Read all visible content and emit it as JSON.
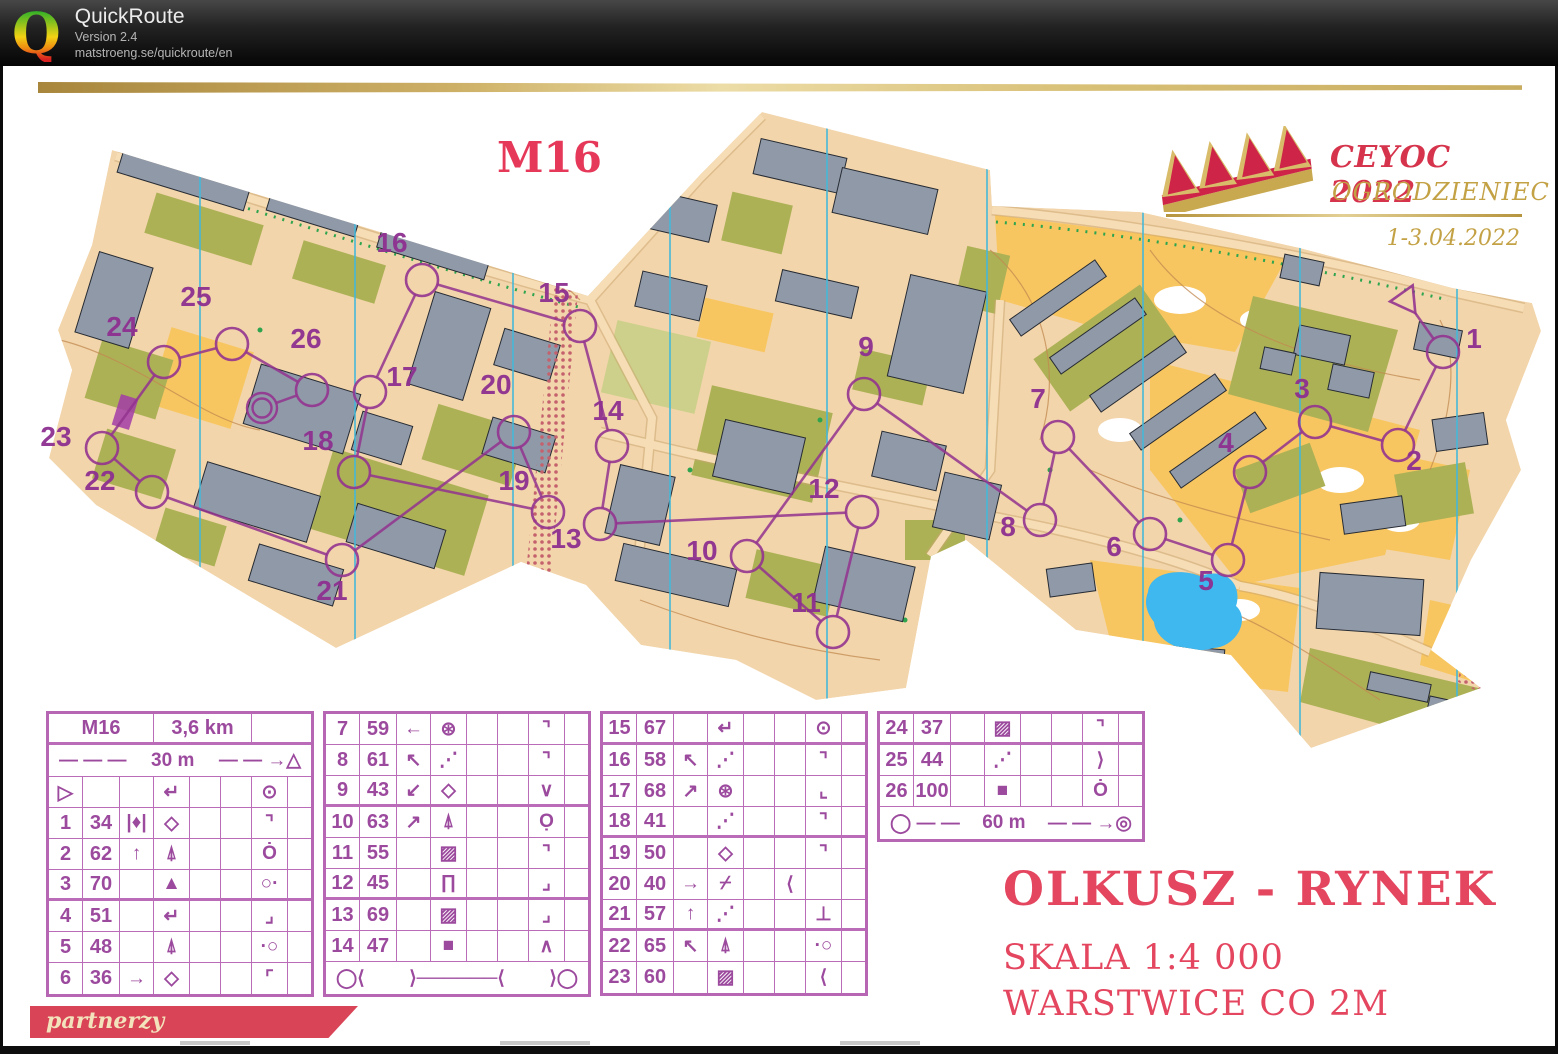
{
  "header": {
    "app_name": "QuickRoute",
    "version": "Version 2.4",
    "url": "matstroeng.se/quickroute/en",
    "logo_letter": "Q"
  },
  "map": {
    "class_label": "M16",
    "event": {
      "title": "CEYOC 2022",
      "location": "OGRODZIENIEC",
      "dates": "1-3.04.2022"
    },
    "titles": {
      "name": "OLKUSZ - RYNEK",
      "scale": "SKALA 1:4 000",
      "contours": "WARSTWICE CO 2M",
      "partners": "partnerzy"
    },
    "colors": {
      "course_purple": "#93348f",
      "crimson": "#e6395a",
      "gold": "#c2a14e",
      "olive_green": "#adb156",
      "building_gray": "#9099a8",
      "paved_tan": "#f2d5ab",
      "open_orange": "#f8c661",
      "water_blue": "#3fb7ef",
      "north_line_cyan": "#45b8d8",
      "oob_red": "#c4616d"
    },
    "north_lines_x": [
      200,
      355,
      513,
      670,
      827,
      987,
      1143,
      1300,
      1457
    ],
    "start": {
      "x": 1406,
      "y": 300
    },
    "finish": {
      "x": 262,
      "y": 408
    },
    "controls": [
      {
        "n": "1",
        "cx": 1443,
        "cy": 352,
        "lx": 1474,
        "ly": 348
      },
      {
        "n": "2",
        "cx": 1398,
        "cy": 445,
        "lx": 1414,
        "ly": 470
      },
      {
        "n": "3",
        "cx": 1315,
        "cy": 422,
        "lx": 1302,
        "ly": 398
      },
      {
        "n": "4",
        "cx": 1250,
        "cy": 472,
        "lx": 1226,
        "ly": 452
      },
      {
        "n": "5",
        "cx": 1228,
        "cy": 560,
        "lx": 1206,
        "ly": 590
      },
      {
        "n": "6",
        "cx": 1150,
        "cy": 534,
        "lx": 1114,
        "ly": 556
      },
      {
        "n": "7",
        "cx": 1058,
        "cy": 437,
        "lx": 1038,
        "ly": 408
      },
      {
        "n": "8",
        "cx": 1040,
        "cy": 520,
        "lx": 1008,
        "ly": 536
      },
      {
        "n": "9",
        "cx": 864,
        "cy": 394,
        "lx": 866,
        "ly": 356
      },
      {
        "n": "10",
        "cx": 747,
        "cy": 556,
        "lx": 702,
        "ly": 560
      },
      {
        "n": "11",
        "cx": 833,
        "cy": 632,
        "lx": 806,
        "ly": 612
      },
      {
        "n": "12",
        "cx": 862,
        "cy": 512,
        "lx": 824,
        "ly": 498
      },
      {
        "n": "13",
        "cx": 600,
        "cy": 524,
        "lx": 566,
        "ly": 548
      },
      {
        "n": "14",
        "cx": 612,
        "cy": 446,
        "lx": 608,
        "ly": 420
      },
      {
        "n": "15",
        "cx": 580,
        "cy": 326,
        "lx": 554,
        "ly": 302
      },
      {
        "n": "16",
        "cx": 422,
        "cy": 280,
        "lx": 392,
        "ly": 252
      },
      {
        "n": "17",
        "cx": 370,
        "cy": 392,
        "lx": 402,
        "ly": 386
      },
      {
        "n": "18",
        "cx": 354,
        "cy": 472,
        "lx": 318,
        "ly": 450
      },
      {
        "n": "19",
        "cx": 548,
        "cy": 512,
        "lx": 514,
        "ly": 490
      },
      {
        "n": "20",
        "cx": 514,
        "cy": 432,
        "lx": 496,
        "ly": 394
      },
      {
        "n": "21",
        "cx": 342,
        "cy": 560,
        "lx": 332,
        "ly": 600
      },
      {
        "n": "22",
        "cx": 152,
        "cy": 492,
        "lx": 100,
        "ly": 490
      },
      {
        "n": "23",
        "cx": 102,
        "cy": 448,
        "lx": 56,
        "ly": 446
      },
      {
        "n": "24",
        "cx": 164,
        "cy": 362,
        "lx": 122,
        "ly": 336
      },
      {
        "n": "25",
        "cx": 232,
        "cy": 344,
        "lx": 196,
        "ly": 306
      },
      {
        "n": "26",
        "cx": 312,
        "cy": 390,
        "lx": 306,
        "ly": 348
      }
    ]
  },
  "descriptions": {
    "class": "M16",
    "length": "3,6 km",
    "climb": "",
    "start_distance": "30 m",
    "finish_distance": "60 m",
    "specials": {
      "dist_start_left": "— — —",
      "dist_start_right": "— — →△",
      "marked_left": "◯⟨",
      "marked_mid": "⟩──────⟨",
      "marked_right": "⟩◯",
      "finish_left": "◯ — —",
      "finish_right": "— — →◎"
    },
    "glyphs": {
      "start": "▷",
      "spur": "↵",
      "between": "|♦|",
      "boulder": "◇",
      "tree": "⍋",
      "hill": "▲",
      "thicket": "⊛",
      "wall": "⋰",
      "fence": "⋰",
      "paved": "▨",
      "canopy": "∏",
      "building": "■",
      "cliff": "⌿",
      "arrow-up": "↑",
      "arrow-left": "←",
      "arrow-right": "→",
      "arrow-nw": "↖",
      "arrow-sw": "↙",
      "arrow-ne": "↗",
      "center": "⊙",
      "circle-dot": "⊙",
      "corner-ne": "⌝",
      "corner-nw": "⌜",
      "corner-se": "⌟",
      "corner-sw": "⌞",
      "dot-top": "Ȯ",
      "dot-right": "○·",
      "dot-left": "·○",
      "dot-bottom": "Ọ",
      "vee": "∨",
      "wedge": "∧",
      "foot": "⊥",
      "between-lt": "⟨",
      "between-gt": "⟩"
    },
    "rows": [
      {
        "n": "start",
        "code": "",
        "c": "",
        "d": "spur",
        "e": "",
        "f": "",
        "g": "center",
        "h": ""
      },
      {
        "n": "1",
        "code": "34",
        "c": "between",
        "d": "boulder",
        "e": "",
        "f": "",
        "g": "corner-ne",
        "h": ""
      },
      {
        "n": "2",
        "code": "62",
        "c": "arrow-up",
        "d": "tree",
        "e": "",
        "f": "",
        "g": "dot-top",
        "h": ""
      },
      {
        "n": "3",
        "code": "70",
        "c": "",
        "d": "hill",
        "e": "",
        "f": "",
        "g": "dot-right",
        "h": ""
      },
      {
        "n": "4",
        "code": "51",
        "c": "",
        "d": "spur",
        "e": "",
        "f": "",
        "g": "corner-se",
        "h": ""
      },
      {
        "n": "5",
        "code": "48",
        "c": "",
        "d": "tree",
        "e": "",
        "f": "",
        "g": "dot-left",
        "h": ""
      },
      {
        "n": "6",
        "code": "36",
        "c": "arrow-right",
        "d": "boulder",
        "e": "",
        "f": "",
        "g": "corner-nw",
        "h": ""
      },
      {
        "n": "7",
        "code": "59",
        "c": "arrow-left",
        "d": "thicket",
        "e": "",
        "f": "",
        "g": "corner-ne",
        "h": ""
      },
      {
        "n": "8",
        "code": "61",
        "c": "arrow-nw",
        "d": "wall",
        "e": "",
        "f": "",
        "g": "corner-ne",
        "h": ""
      },
      {
        "n": "9",
        "code": "43",
        "c": "arrow-sw",
        "d": "boulder",
        "e": "",
        "f": "",
        "g": "vee",
        "h": ""
      },
      {
        "n": "10",
        "code": "63",
        "c": "arrow-ne",
        "d": "tree",
        "e": "",
        "f": "",
        "g": "dot-bottom",
        "h": ""
      },
      {
        "n": "11",
        "code": "55",
        "c": "",
        "d": "paved",
        "e": "",
        "f": "",
        "g": "corner-ne",
        "h": ""
      },
      {
        "n": "12",
        "code": "45",
        "c": "",
        "d": "canopy",
        "e": "",
        "f": "",
        "g": "corner-se",
        "h": ""
      },
      {
        "n": "13",
        "code": "69",
        "c": "",
        "d": "paved",
        "e": "",
        "f": "",
        "g": "corner-se",
        "h": ""
      },
      {
        "n": "14",
        "code": "47",
        "c": "",
        "d": "building",
        "e": "",
        "f": "",
        "g": "wedge",
        "h": ""
      },
      {
        "n": "15",
        "code": "67",
        "c": "",
        "d": "spur",
        "e": "",
        "f": "",
        "g": "circle-dot",
        "h": ""
      },
      {
        "n": "16",
        "code": "58",
        "c": "arrow-nw",
        "d": "fence",
        "e": "",
        "f": "",
        "g": "corner-ne",
        "h": ""
      },
      {
        "n": "17",
        "code": "68",
        "c": "arrow-ne",
        "d": "thicket",
        "e": "",
        "f": "",
        "g": "corner-sw",
        "h": ""
      },
      {
        "n": "18",
        "code": "41",
        "c": "",
        "d": "fence",
        "e": "",
        "f": "",
        "g": "corner-ne",
        "h": ""
      },
      {
        "n": "19",
        "code": "50",
        "c": "",
        "d": "boulder",
        "e": "",
        "f": "",
        "g": "corner-ne",
        "h": ""
      },
      {
        "n": "20",
        "code": "40",
        "c": "arrow-right",
        "d": "cliff",
        "e": "",
        "f": "between-lt",
        "g": "",
        "h": ""
      },
      {
        "n": "21",
        "code": "57",
        "c": "arrow-up",
        "d": "wall",
        "e": "",
        "f": "",
        "g": "foot",
        "h": ""
      },
      {
        "n": "22",
        "code": "65",
        "c": "arrow-nw",
        "d": "tree",
        "e": "",
        "f": "",
        "g": "dot-left",
        "h": ""
      },
      {
        "n": "23",
        "code": "60",
        "c": "",
        "d": "paved",
        "e": "",
        "f": "",
        "g": "between-lt",
        "h": ""
      },
      {
        "n": "24",
        "code": "37",
        "c": "",
        "d": "paved",
        "e": "",
        "f": "",
        "g": "corner-ne",
        "h": ""
      },
      {
        "n": "25",
        "code": "44",
        "c": "",
        "d": "fence",
        "e": "",
        "f": "",
        "g": "between-gt",
        "h": ""
      },
      {
        "n": "26",
        "code": "100",
        "c": "",
        "d": "building",
        "e": "",
        "f": "",
        "g": "dot-top",
        "h": ""
      }
    ]
  }
}
